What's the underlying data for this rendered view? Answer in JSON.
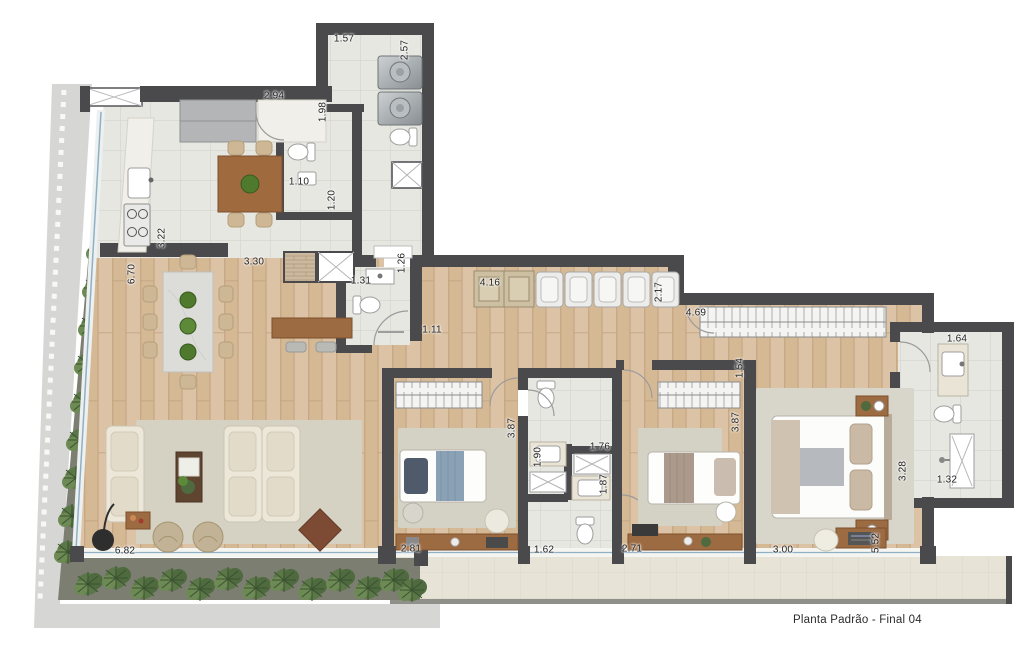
{
  "caption": "Planta Padrão - Final 04",
  "colors": {
    "wall": "#4a4a4c",
    "wood_floor": "#d9bd9f",
    "tile_floor": "#e7e7e2",
    "balcony_floor": "#e7e3d6",
    "sidewalk": "#d6d6d4",
    "garden_bed": "#7c7e72",
    "plant_green": "#5b7747",
    "glass_blue": "#8fb0c4",
    "furniture_wood": "#9c6b42",
    "blanket_blue": "#8ba1b5"
  },
  "dims": [
    {
      "name": "laundry-width",
      "value": "1.57"
    },
    {
      "name": "laundry-depth",
      "value": "2.57"
    },
    {
      "name": "kitchen-top-width",
      "value": "2.94"
    },
    {
      "name": "service-wc-depth",
      "value": "1.98"
    },
    {
      "name": "service-wc-width",
      "value": "1.10"
    },
    {
      "name": "service-wc-length",
      "value": "1.20"
    },
    {
      "name": "kitchen-counter-length",
      "value": "3.22"
    },
    {
      "name": "living-length",
      "value": "6.70"
    },
    {
      "name": "kitchen-opening-width",
      "value": "3.30"
    },
    {
      "name": "lavabo-width",
      "value": "1.31"
    },
    {
      "name": "lavabo-depth",
      "value": "1.26"
    },
    {
      "name": "hall-width",
      "value": "1.11"
    },
    {
      "name": "closet-run-length",
      "value": "4.16"
    },
    {
      "name": "closet-run-depth",
      "value": "2.17"
    },
    {
      "name": "master-wardrobe-length",
      "value": "4.69"
    },
    {
      "name": "master-bath-vanity-width",
      "value": "1.64"
    },
    {
      "name": "master-entry-width",
      "value": "1.54"
    },
    {
      "name": "bedroom1-depth",
      "value": "3.87"
    },
    {
      "name": "bedroom2-depth",
      "value": "3.87"
    },
    {
      "name": "bath1-width",
      "value": "1.90"
    },
    {
      "name": "bath2-width",
      "value": "1.76"
    },
    {
      "name": "bath2-vanity-width",
      "value": "1.87"
    },
    {
      "name": "master-bath-depth",
      "value": "3.28"
    },
    {
      "name": "master-bath-width",
      "value": "1.32"
    },
    {
      "name": "bath-length",
      "value": "1.62"
    },
    {
      "name": "bedroom1-width",
      "value": "2.81"
    },
    {
      "name": "bedroom2-width",
      "value": "2.71"
    },
    {
      "name": "master-width",
      "value": "3.00"
    },
    {
      "name": "master-length",
      "value": "5.52"
    },
    {
      "name": "living-width",
      "value": "6.82"
    }
  ]
}
